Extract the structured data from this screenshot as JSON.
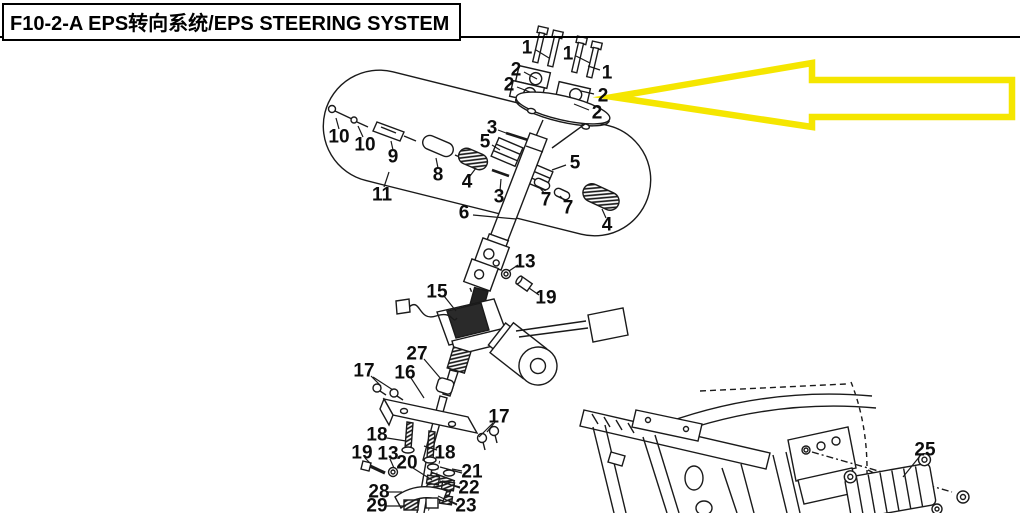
{
  "header": {
    "title": "F10-2-A EPS转向系统/EPS STEERING SYSTEM"
  },
  "highlight": {
    "arrow_color": "#F5E600",
    "arrow_direction": "left"
  },
  "diagram": {
    "callouts": [
      {
        "n": "1",
        "x": 527,
        "y": 48,
        "leaders": [
          [
            536,
            50,
            549,
            58
          ]
        ]
      },
      {
        "n": "1",
        "x": 568,
        "y": 54,
        "leaders": [
          [
            576,
            56,
            590,
            63
          ]
        ]
      },
      {
        "n": "1",
        "x": 607,
        "y": 73,
        "leaders": [
          [
            600,
            70,
            588,
            66
          ]
        ]
      },
      {
        "n": "2",
        "x": 516,
        "y": 70,
        "leaders": [
          [
            524,
            72,
            537,
            79
          ]
        ]
      },
      {
        "n": "2",
        "x": 509,
        "y": 85,
        "leaders": [
          [
            517,
            87,
            530,
            92
          ]
        ]
      },
      {
        "n": "2",
        "x": 603,
        "y": 96,
        "leaders": [
          [
            594,
            94,
            581,
            91
          ]
        ]
      },
      {
        "n": "2",
        "x": 597,
        "y": 113,
        "leaders": [
          [
            589,
            110,
            574,
            104
          ]
        ]
      },
      {
        "n": "3",
        "x": 492,
        "y": 128,
        "leaders": [
          [
            498,
            130,
            506,
            133
          ]
        ]
      },
      {
        "n": "3",
        "x": 499,
        "y": 197,
        "leaders": [
          [
            500,
            191,
            501,
            179
          ]
        ]
      },
      {
        "n": "5",
        "x": 485,
        "y": 142,
        "leaders": [
          [
            492,
            145,
            500,
            150
          ]
        ]
      },
      {
        "n": "5",
        "x": 575,
        "y": 163,
        "leaders": [
          [
            566,
            165,
            552,
            170
          ]
        ]
      },
      {
        "n": "4",
        "x": 467,
        "y": 182,
        "leaders": [
          [
            470,
            176,
            476,
            168
          ]
        ]
      },
      {
        "n": "4",
        "x": 607,
        "y": 225,
        "leaders": [
          [
            606,
            218,
            602,
            209
          ]
        ]
      },
      {
        "n": "6",
        "x": 464,
        "y": 213,
        "leaders": [
          [
            473,
            215,
            516,
            219
          ]
        ]
      },
      {
        "n": "7",
        "x": 546,
        "y": 200,
        "leaders": [
          [
            545,
            194,
            540,
            188
          ]
        ]
      },
      {
        "n": "7",
        "x": 568,
        "y": 208,
        "leaders": [
          [
            566,
            202,
            560,
            196
          ]
        ]
      },
      {
        "n": "8",
        "x": 438,
        "y": 175,
        "leaders": [
          [
            438,
            168,
            436,
            158
          ]
        ]
      },
      {
        "n": "9",
        "x": 393,
        "y": 157,
        "leaders": [
          [
            393,
            150,
            391,
            141
          ]
        ]
      },
      {
        "n": "10",
        "x": 339,
        "y": 137,
        "leaders": [
          [
            339,
            129,
            336,
            118
          ]
        ]
      },
      {
        "n": "10",
        "x": 365,
        "y": 145,
        "leaders": [
          [
            363,
            137,
            358,
            126
          ]
        ]
      },
      {
        "n": "11",
        "x": 382,
        "y": 195,
        "leaders": [
          [
            384,
            187,
            389,
            172
          ]
        ]
      },
      {
        "n": "13",
        "x": 525,
        "y": 262,
        "leaders": [
          [
            518,
            265,
            509,
            271
          ]
        ]
      },
      {
        "n": "19",
        "x": 546,
        "y": 298,
        "leaders": [
          [
            539,
            295,
            529,
            288
          ]
        ]
      },
      {
        "n": "15",
        "x": 437,
        "y": 292,
        "leaders": [
          [
            444,
            296,
            456,
            311
          ]
        ]
      },
      {
        "n": "27",
        "x": 417,
        "y": 354,
        "leaders": [
          [
            424,
            359,
            441,
            379
          ]
        ]
      },
      {
        "n": "16",
        "x": 405,
        "y": 373,
        "leaders": [
          [
            411,
            378,
            424,
            398
          ]
        ]
      },
      {
        "n": "17",
        "x": 364,
        "y": 371,
        "leaders": [
          [
            371,
            376,
            381,
            386
          ],
          [
            373,
            377,
            393,
            390
          ]
        ]
      },
      {
        "n": "17",
        "x": 499,
        "y": 417,
        "leaders": [
          [
            495,
            422,
            487,
            432
          ],
          [
            493,
            423,
            479,
            437
          ]
        ]
      },
      {
        "n": "18",
        "x": 377,
        "y": 435,
        "leaders": [
          [
            387,
            438,
            406,
            441
          ]
        ]
      },
      {
        "n": "18",
        "x": 445,
        "y": 453,
        "leaders": [
          [
            437,
            450,
            424,
            446
          ]
        ]
      },
      {
        "n": "19",
        "x": 362,
        "y": 453,
        "leaders": [
          [
            365,
            458,
            371,
            464
          ]
        ]
      },
      {
        "n": "13",
        "x": 388,
        "y": 454,
        "leaders": [
          [
            390,
            459,
            394,
            468
          ]
        ]
      },
      {
        "n": "20",
        "x": 407,
        "y": 463,
        "leaders": [
          [
            413,
            468,
            432,
            480
          ]
        ]
      },
      {
        "n": "21",
        "x": 472,
        "y": 472,
        "leaders": [
          [
            462,
            471,
            452,
            469
          ],
          [
            462,
            473,
            440,
            467
          ]
        ]
      },
      {
        "n": "22",
        "x": 469,
        "y": 488,
        "leaders": [
          [
            460,
            487,
            452,
            485
          ],
          [
            460,
            488,
            440,
            481
          ]
        ]
      },
      {
        "n": "23",
        "x": 466,
        "y": 506,
        "leaders": [
          [
            457,
            504,
            448,
            500
          ],
          [
            457,
            505,
            438,
            496
          ]
        ]
      },
      {
        "n": "28",
        "x": 379,
        "y": 492,
        "leaders": [
          [
            388,
            492,
            402,
            492
          ]
        ]
      },
      {
        "n": "29",
        "x": 377,
        "y": 506,
        "leaders": [
          [
            386,
            506,
            406,
            506
          ]
        ]
      },
      {
        "n": "25",
        "x": 925,
        "y": 450,
        "leaders": [
          [
            920,
            456,
            903,
            477
          ]
        ]
      }
    ]
  }
}
